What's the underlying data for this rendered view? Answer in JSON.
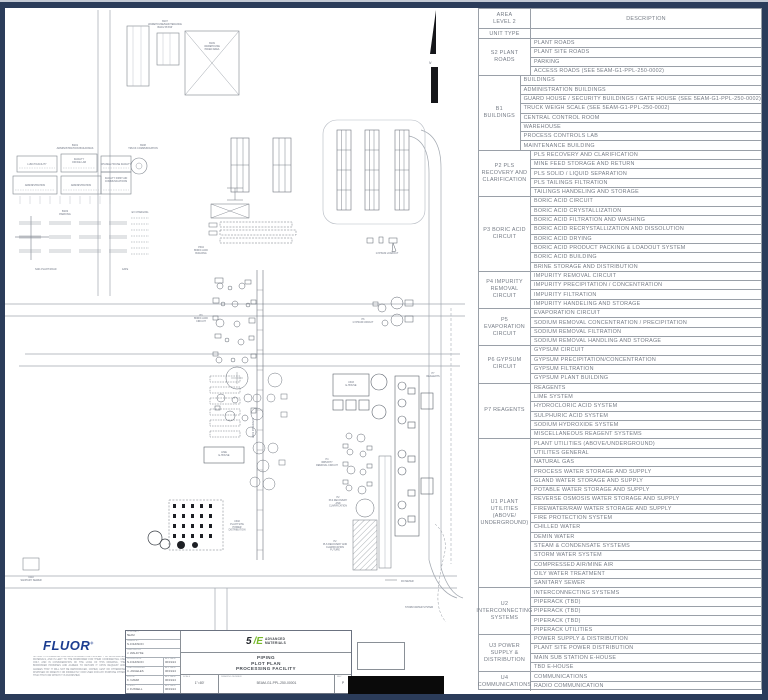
{
  "legend": {
    "header": {
      "col1": "AREA\nLEVEL 2",
      "col2": "DESCRIPTION",
      "row2": "UNIT TYPE"
    },
    "groups": [
      {
        "unit": "S2 PLANT ROADS",
        "items": [
          "PLANT ROADS",
          "PLANT SITE ROADS",
          "PARKING",
          "ACCESS ROADS (SEE 5EAM-G1-PPL-250-0002)"
        ]
      },
      {
        "unit": "B1 BUILDINGS",
        "items": [
          "BUILDINGS",
          "ADMINISTRATION BUILDINGS",
          "GUARD HOUSE / SECURITY BUILDINGS / GATE HOUSE (SEE 5EAM-G1-PPL-250-0002)",
          "TRUCK WEIGH SCALE (SEE 5EAM-G1-PPL-250-0002)",
          "CENTRAL CONTROL ROOM",
          "WAREHOUSE",
          "PROCESS CONTROLS LAB",
          "MAINTENANCE BUILDING"
        ]
      },
      {
        "unit": "P2 PLS RECOVERY AND CLARIFICATION",
        "items": [
          "PLS RECOVERY AND CLARIFICATION",
          "MINE FEED STORAGE AND RETURN",
          "PLS SOLID / LIQUID SEPARATION",
          "PLS TAILINGS FILTRATION",
          "TAILINGS HANDELING AND STORAGE"
        ]
      },
      {
        "unit": "P3 BORIC ACID CIRCUIT",
        "items": [
          "BORIC ACID CIRCUIT",
          "BORIC ACID CRYSTALLIZATION",
          "BORIC ACID FILTRATION AND WASHING",
          "BORIC ACID RECRYSTALLIZATION AND DISSOLUTION",
          "BORIC ACID DRYING",
          "BORIC ACID PRODUCT PACKING & LOADOUT SYSTEM",
          "BORIC ACID BUILDING",
          "BRINE STORAGE AND DISTRIBUTION"
        ]
      },
      {
        "unit": "P4 IMPURITY REMOVAL CIRCUIT",
        "items": [
          "IMPURITY REMOVAL CIRCUIT",
          "IMPURITY PRECIPITATION / CONCENTRATION",
          "IMPURITY FILTRATION",
          "IMPURITY HANDELING AND STORAGE"
        ]
      },
      {
        "unit": "P5 EVAPORATION CIRCUIT",
        "items": [
          "EVAPORATION CIRCUIT",
          "SODIUM REMOVAL CONCENTRATION / PRECIPITATION",
          "SODIUM REMOVAL FILTRATION",
          "SODIUM REMOVAL HANDLING AND STORAGE"
        ]
      },
      {
        "unit": "P6 GYPSUM CIRCUIT",
        "items": [
          "GYPSUM CIRCUIT",
          "GYPSUM PRECIPITATION/CONCENTRATION",
          "GYPSUM FILTRATION",
          "GYPSUM PLANT BUILDING"
        ]
      },
      {
        "unit": "P7 REAGENTS",
        "items": [
          "REAGENTS",
          "LIME SYSTEM",
          "HYDROCLORIC ACID SYSTEM",
          "SULPHURIC ACID SYSTEM",
          "SODIUM HYDROXIDE SYSTEM",
          "MISCELLANEOUS REAGENT SYSTEMS"
        ]
      },
      {
        "unit": "U1 PLANT UTILITIES (ABOVE/ UNDERGROUND)",
        "items": [
          "PLANT UTILITIES (ABOVE/UNDERGROUND)",
          "UTILITES GENERAL",
          "NATURAL GAS",
          "PROCESS WATER STORAGE AND SUPPLY",
          "GLAND WATER STORAGE AND SUPPLY",
          "POTABLE WATER STORAGE AND SUPPLY",
          "REVERSE OSMOSIS WATER STORAGE AND SUPPLY",
          "FIREWATER/RAW WATER STORAGE AND SUPPLY",
          "FIRE PROTECTION SYSTEM",
          "CHILLED WATER",
          "DEMIN WATER",
          "STEAM & CONDENSATE SYSTEMS",
          "STORM WATER SYSTEM",
          "COMPRESSED AIR/MINE AIR",
          "OILY WATER TREATMENT",
          "SANITARY SEWER"
        ]
      },
      {
        "unit": "U2 INTERCONNECTING SYSTEMS",
        "items": [
          "INTERCONNECTING SYSTEMS",
          "PIPERACK (TBD)",
          "PIPERACK (TBD)",
          "PIPERACK (TBD)",
          "PIPERACK UTILITIES"
        ]
      },
      {
        "unit": "U3 POWER SUPPLY & DISTRIBUTION",
        "items": [
          "POWER SUPPLY & DISTRIBUTION",
          "PLANT SITE POWER DISTRIBUTION",
          "MAIN SUB STATION E-HOUSE",
          "TBD E-HOUSE"
        ]
      },
      {
        "unit": "U4 COMMUNICATIONS",
        "items": [
          "COMMUNICATIONS",
          "RADIO COMMUNICATION"
        ]
      }
    ]
  },
  "plan": {
    "labels": {
      "north": "N",
      "b107": "B107\nWAREHOUSE/MAINTENANCE\nBLDG 56'X96'",
      "b109": "B109\nWAREHOUSE\nPAVED AREA",
      "b101": "B101\nADMINISTRATION BUILDINGS",
      "lunch": "LUNCH FACILITY",
      "office": "FACILITY\nOFFICE LAB",
      "change": "CHANGE HOUSE FACILITY",
      "admin1": "ADMINISTRATION",
      "admin2": "ADMINISTRATION",
      "firstaid": "FACILITY FIRST AID\nCOMMUNICATIONS",
      "b108": "B108\nTRUCK COMMUNICATION",
      "b103": "B103\nPARKING",
      "ev": "EV CHARGING",
      "gate": "GATE",
      "s201": "S201 PLANT ROAD",
      "p304": "P304\nBORIC ACID\nBUILDING",
      "p3circuit": "P3\nBORIC ACID\nCIRCUIT",
      "gypsum_loadout": "GYPSUM LOADOUT",
      "p6": "P6\nGYPSUM CIRCUIT",
      "p7": "P7\nREAGENTS",
      "u303": "U303\nE-HOUSE",
      "lime": "LIME\nE-HOUSE",
      "p4": "P4\nIMPURITY\nREMOVAL CIRCUIT",
      "p2": "P2\nPLS RECOVERY\nAND\nCLARIFICATION",
      "p2future": "P2\nPLS RECOVERY AND\nCLARIFICATION\nFUTURE",
      "u302": "U302\nPLANT SITE\nPOWER\nDISTRIBUTION",
      "u201": "U201 PIPERACK",
      "storm": "STORM WATER SYSTEM",
      "ro": "RO METER",
      "sanitary": "U110\nSANITARY SEWER"
    }
  },
  "title_block": {
    "fluor_logo": "FLUOR",
    "fluor_reg": "®",
    "notice": "NOTICE: THIS DRAWING CONTAINS INTELLECTUAL PROPERTY OF 5E ADVANCED MATERIALS, AND IS LENT TO THE BORROWER FOR THEIR CONFIDENTIAL USE ONLY, AND IN CONSIDERATION OF THE LOAN OF THIS DRAWING, THE BORROWER PROMISES AND AGREES TO RETURN IT UPON REQUEST AND AGREES THAT IT WILL NOT BE REPRODUCED, COPIED, LENT OR OTHERWISE DISPOSED OF DIRECTLY OR INDIRECTLY, NOR USED FOR ANY PURPOSE OTHER THAN THAT FOR WHICH IT IS FURNISHED.",
    "personnel": [
      {
        "label": "CONTRACT",
        "value": "5EAM",
        "date": ""
      },
      {
        "label": "DRAWN BY",
        "value": "N.JOHNSON",
        "date": ""
      },
      {
        "label": "CHECKED BY",
        "value": "J. WALDYKE",
        "date": ""
      },
      {
        "label": "SUPERVISOR",
        "value": "N.JOHNSON",
        "date": "06/19/24"
      },
      {
        "label": "LEAD ENGINEER",
        "value": "C. ANGELES",
        "date": "06/19/24"
      },
      {
        "label": "FLUOR",
        "value": "K. NAMM",
        "date": "06/19/24"
      },
      {
        "label": "CLIENT",
        "value": "J. FUSSELL",
        "date": "06/19/24"
      }
    ],
    "app_date_label": "APP DATE",
    "logo_5e": {
      "five": "5",
      "e": "/E",
      "line1": "ADVANCED",
      "line2": "MATERIALS"
    },
    "title_lines": [
      "PIPING",
      "PLOT PLAN",
      "PROCESSING FACILITY"
    ],
    "scale_label": "SCALE",
    "scale": "1\"=80'",
    "dwg_label": "DRAWING NUMBER",
    "dwg": "5EAM-G1-PPL-250-00001",
    "rev_label": "REV",
    "rev": "P"
  },
  "colors": {
    "frame": "#2b3c5a",
    "line": "#9aa0a8",
    "text": "#767c86",
    "fluor_blue": "#1c3d90",
    "logo_green": "#76b82a"
  }
}
